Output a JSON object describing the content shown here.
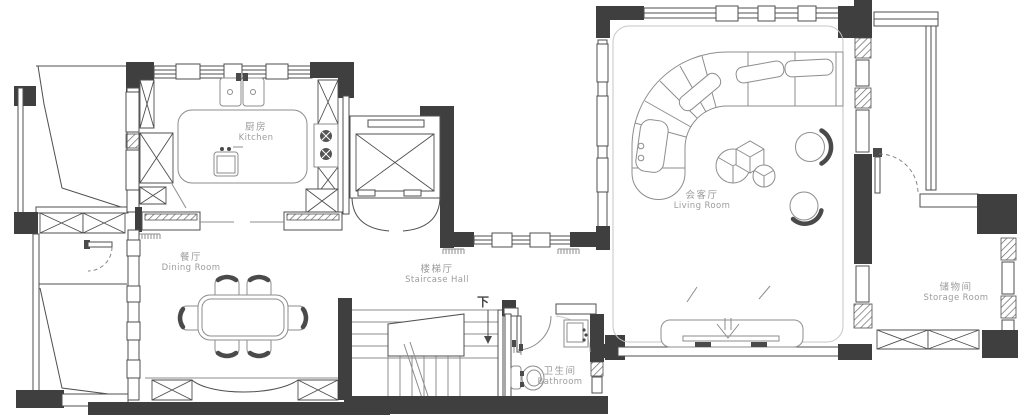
{
  "rooms": {
    "kitchen": {
      "zh": "厨房",
      "en": "Kitchen"
    },
    "dining_room": {
      "zh": "餐厅",
      "en": "Dining Room"
    },
    "staircase_hall": {
      "zh": "楼梯厅",
      "en": "Staircase Hall"
    },
    "living_room": {
      "zh": "会客厅",
      "en": "Living Room"
    },
    "storage_room": {
      "zh": "储物间",
      "en": "Storage Room"
    },
    "bathroom": {
      "zh": "卫生间",
      "en": "Bathroom"
    }
  },
  "annotations": {
    "stairs_down": "下"
  },
  "colors": {
    "wall": "#3f3f3f",
    "line": "#4f4f4f",
    "furniture_line": "#8d8d8d",
    "label": "#9c9c9c",
    "background": "#ffffff"
  }
}
